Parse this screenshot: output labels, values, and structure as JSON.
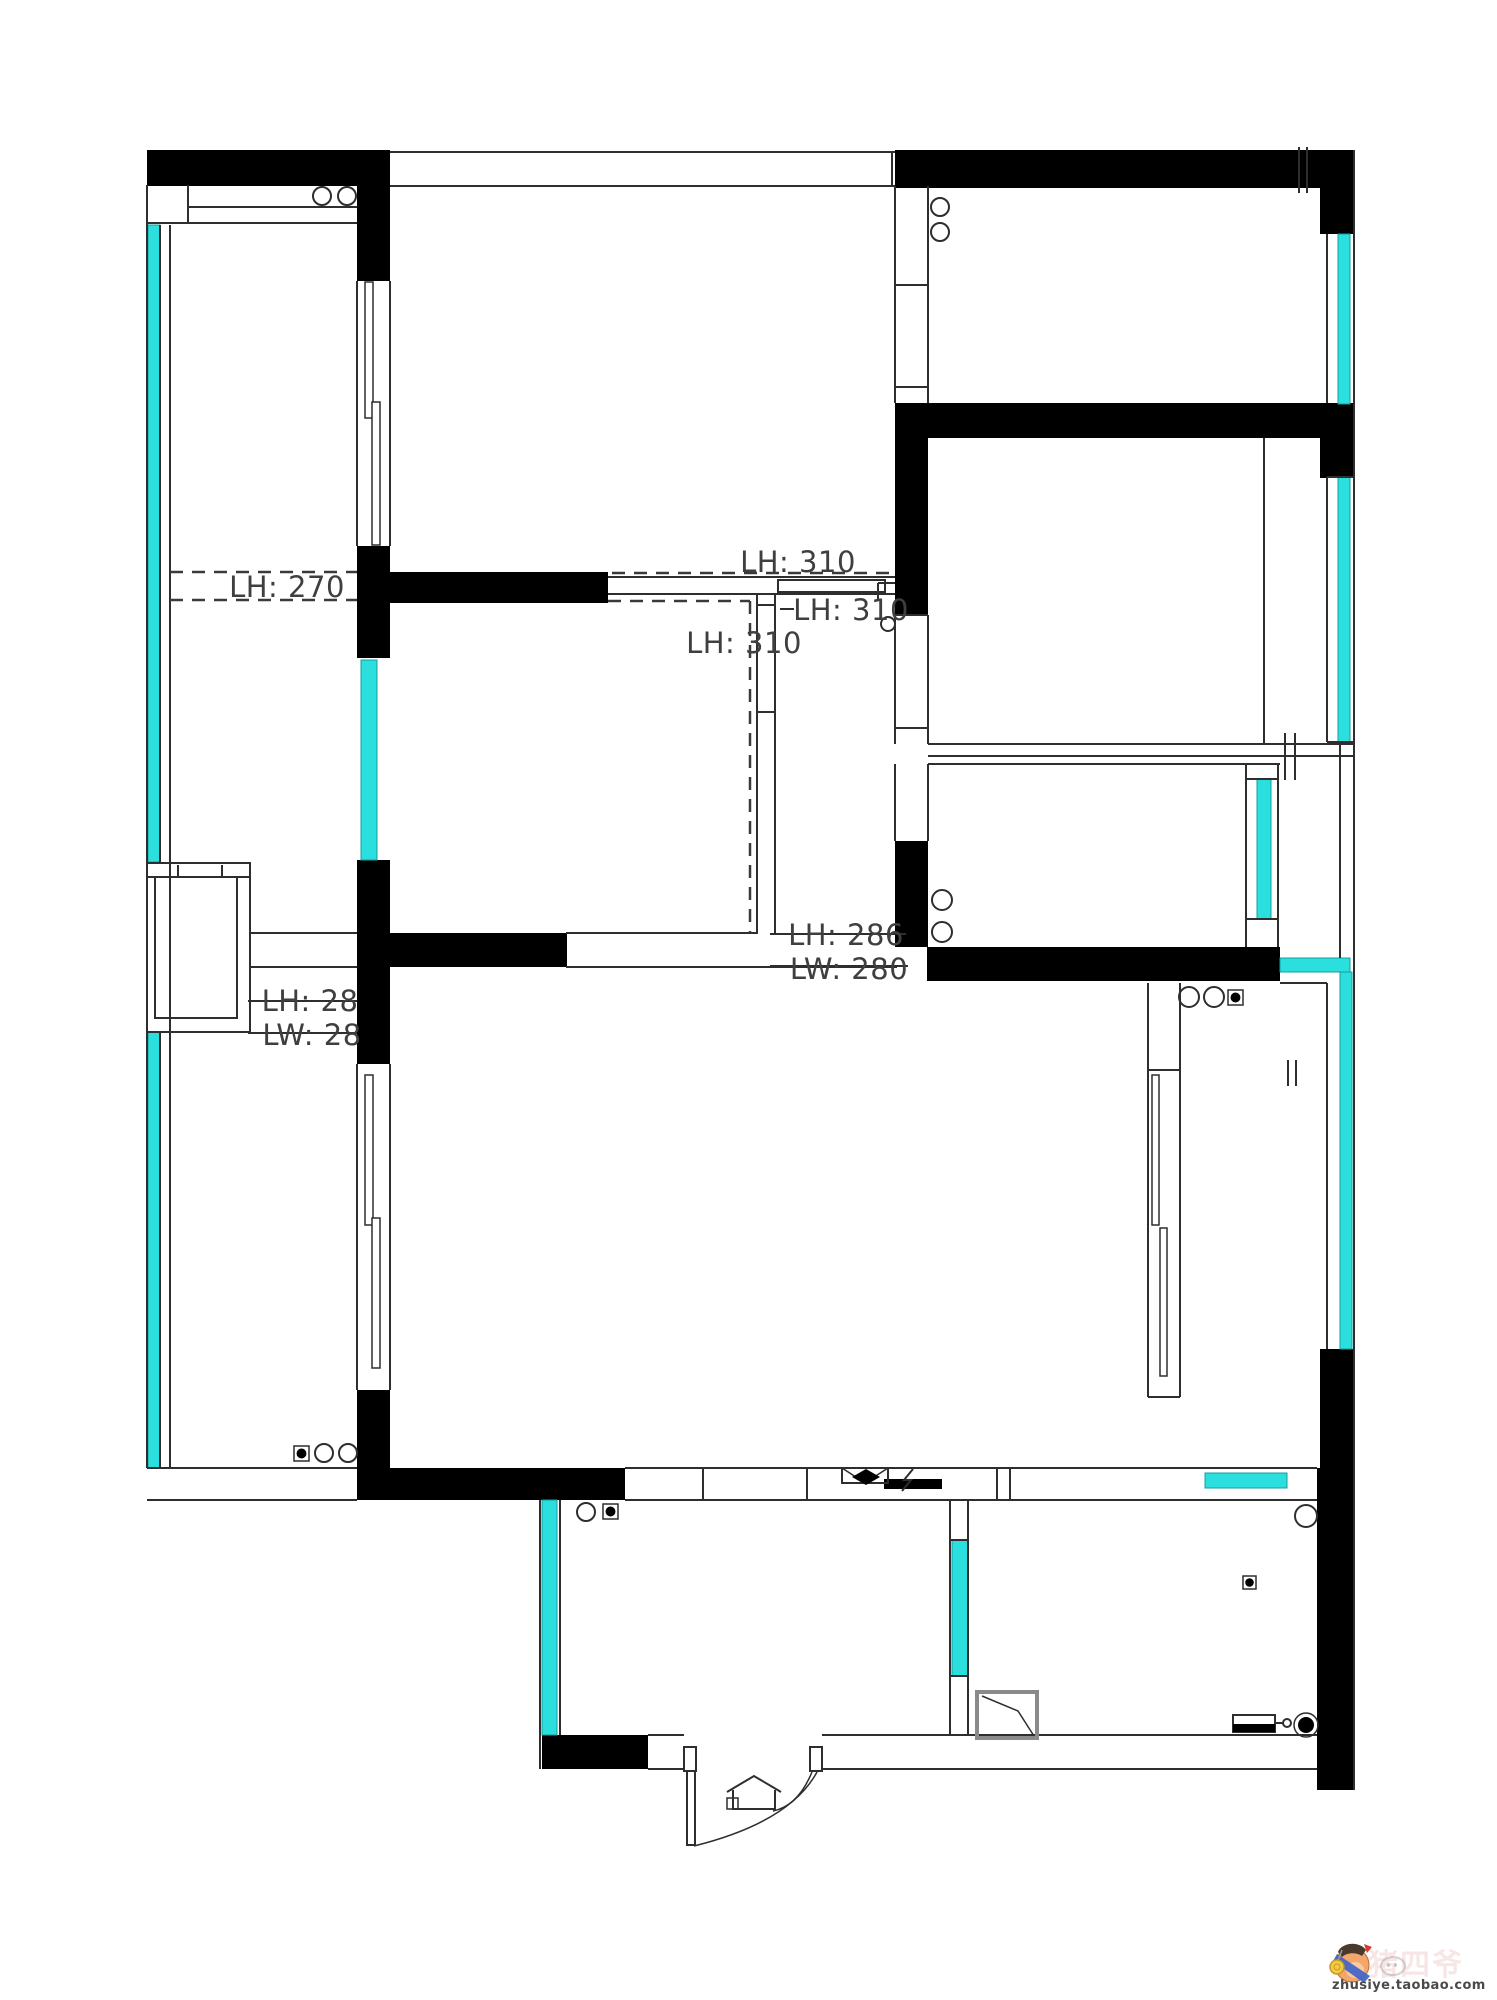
{
  "meta": {
    "width": 1497,
    "height": 2000,
    "bg": "#ffffff"
  },
  "colors": {
    "wall": "#000000",
    "window": "#2bdfdf",
    "window_edge": "#149c9c",
    "line": "#2e2e2e",
    "dash": "#3a3a3a",
    "label": "#3f3f3f",
    "shower_edge": "#8a8a8a"
  },
  "labels": [
    {
      "text": "LH: 270",
      "x": 287,
      "y": 597,
      "size": 29
    },
    {
      "text": "LH: 310",
      "x": 798,
      "y": 572,
      "size": 29
    },
    {
      "text": "LH: 310",
      "x": 851,
      "y": 620,
      "size": 29
    },
    {
      "text": "LH: 310",
      "x": 744,
      "y": 653,
      "size": 29
    },
    {
      "text": "LH: 286",
      "x": 846,
      "y": 945,
      "size": 29
    },
    {
      "text": "LW: 280",
      "x": 849,
      "y": 979,
      "size": 29
    },
    {
      "text": "LH: 28",
      "x": 310,
      "y": 1011,
      "size": 29
    },
    {
      "text": "LW: 28",
      "x": 312,
      "y": 1045,
      "size": 29
    }
  ],
  "walls": [
    [
      147,
      150,
      243,
      36
    ],
    [
      895,
      150,
      459,
      38
    ],
    [
      1320,
      150,
      34,
      84
    ],
    [
      357,
      185,
      33,
      96
    ],
    [
      357,
      546,
      33,
      112
    ],
    [
      390,
      572,
      218,
      31
    ],
    [
      895,
      403,
      33,
      212
    ],
    [
      895,
      403,
      459,
      35
    ],
    [
      1320,
      438,
      34,
      40
    ],
    [
      357,
      860,
      33,
      204
    ],
    [
      390,
      933,
      177,
      34
    ],
    [
      895,
      841,
      33,
      106
    ],
    [
      927,
      947,
      353,
      34
    ],
    [
      1320,
      1349,
      34,
      120
    ],
    [
      357,
      1390,
      33,
      110
    ],
    [
      390,
      1468,
      235,
      32
    ],
    [
      884,
      1479,
      58,
      10
    ],
    [
      1317,
      1468,
      37,
      322
    ],
    [
      542,
      1735,
      106,
      34
    ]
  ],
  "windows": [
    [
      148,
      225,
      12,
      637
    ],
    [
      148,
      1032,
      12,
      436
    ],
    [
      361,
      660,
      16,
      200
    ],
    [
      1338,
      234,
      12,
      170
    ],
    [
      1338,
      477,
      12,
      265
    ],
    [
      1257,
      779,
      14,
      140
    ],
    [
      1280,
      958,
      70,
      14
    ],
    [
      1340,
      972,
      12,
      377
    ],
    [
      542,
      1500,
      15,
      235
    ],
    [
      952,
      1540,
      16,
      136
    ],
    [
      1205,
      1473,
      82,
      15
    ]
  ],
  "lines": [
    [
      147,
      185,
      147,
      1468
    ],
    [
      160,
      225,
      160,
      862
    ],
    [
      160,
      1032,
      160,
      1468
    ],
    [
      170,
      225,
      170,
      1468
    ],
    [
      148,
      223,
      357,
      223
    ],
    [
      188,
      185,
      188,
      223
    ],
    [
      188,
      207,
      357,
      207
    ],
    [
      147,
      1468,
      357,
      1468
    ],
    [
      147,
      1500,
      357,
      1500
    ],
    [
      390,
      152,
      895,
      152
    ],
    [
      390,
      186,
      895,
      186
    ],
    [
      892,
      152,
      892,
      186
    ],
    [
      895,
      186,
      895,
      403
    ],
    [
      928,
      186,
      928,
      403
    ],
    [
      895,
      285,
      928,
      285
    ],
    [
      895,
      387,
      928,
      387
    ],
    [
      1354,
      150,
      1354,
      1790
    ],
    [
      1327,
      234,
      1327,
      403
    ],
    [
      1327,
      477,
      1327,
      742
    ],
    [
      1327,
      983,
      1327,
      1349
    ],
    [
      1327,
      477,
      1354,
      477
    ],
    [
      1327,
      742,
      1354,
      742
    ],
    [
      895,
      615,
      895,
      744
    ],
    [
      928,
      615,
      928,
      744
    ],
    [
      895,
      615,
      928,
      615
    ],
    [
      895,
      728,
      928,
      728
    ],
    [
      1264,
      438,
      1264,
      744
    ],
    [
      928,
      744,
      1354,
      744
    ],
    [
      928,
      756,
      1354,
      756
    ],
    [
      928,
      764,
      1280,
      764
    ],
    [
      878,
      583,
      895,
      583
    ],
    [
      878,
      583,
      878,
      600
    ],
    [
      895,
      764,
      895,
      841
    ],
    [
      928,
      764,
      928,
      841
    ],
    [
      1246,
      764,
      1246,
      947
    ],
    [
      1278,
      764,
      1278,
      947
    ],
    [
      1246,
      779,
      1278,
      779
    ],
    [
      1246,
      919,
      1278,
      919
    ],
    [
      1340,
      742,
      1340,
      958
    ],
    [
      1280,
      983,
      1327,
      983
    ],
    [
      608,
      577,
      895,
      577
    ],
    [
      608,
      594,
      895,
      594
    ],
    [
      757,
      594,
      757,
      933
    ],
    [
      775,
      594,
      775,
      933
    ],
    [
      757,
      605,
      775,
      605
    ],
    [
      757,
      712,
      775,
      712
    ],
    [
      250,
      933,
      357,
      933
    ],
    [
      566,
      933,
      758,
      933
    ],
    [
      250,
      967,
      357,
      967
    ],
    [
      566,
      967,
      897,
      967
    ],
    [
      147,
      877,
      250,
      877
    ],
    [
      178,
      865,
      178,
      877
    ],
    [
      222,
      865,
      222,
      877
    ],
    [
      625,
      1468,
      1317,
      1468
    ],
    [
      625,
      1500,
      1317,
      1500
    ],
    [
      703,
      1468,
      703,
      1500
    ],
    [
      807,
      1468,
      807,
      1500
    ],
    [
      997,
      1468,
      997,
      1500
    ],
    [
      1010,
      1468,
      1010,
      1500
    ],
    [
      1148,
      983,
      1148,
      1397
    ],
    [
      1180,
      983,
      1180,
      1397
    ],
    [
      1148,
      1070,
      1180,
      1070
    ],
    [
      1148,
      1397,
      1180,
      1397
    ],
    [
      357,
      281,
      357,
      546
    ],
    [
      390,
      281,
      390,
      546
    ],
    [
      357,
      1064,
      357,
      1390
    ],
    [
      390,
      1064,
      390,
      1390
    ],
    [
      540,
      1500,
      540,
      1769
    ],
    [
      560,
      1500,
      560,
      1735
    ],
    [
      950,
      1500,
      950,
      1735
    ],
    [
      968,
      1500,
      968,
      1735
    ],
    [
      950,
      1540,
      968,
      1540
    ],
    [
      950,
      1676,
      968,
      1676
    ],
    [
      648,
      1735,
      684,
      1735
    ],
    [
      822,
      1735,
      1317,
      1735
    ],
    [
      648,
      1769,
      684,
      1769
    ],
    [
      822,
      1769,
      1317,
      1769
    ],
    [
      1299,
      147,
      1299,
      193
    ],
    [
      1307,
      147,
      1307,
      193
    ],
    [
      1285,
      733,
      1285,
      780
    ],
    [
      1295,
      733,
      1295,
      780
    ],
    [
      1288,
      1060,
      1288,
      1086
    ],
    [
      1296,
      1060,
      1296,
      1086
    ],
    [
      770,
      934,
      906,
      934
    ],
    [
      770,
      966,
      908,
      966
    ],
    [
      248,
      1001,
      357,
      1001
    ],
    [
      248,
      1033,
      357,
      1033
    ],
    [
      780,
      609,
      794,
      609
    ]
  ],
  "dashes": [
    [
      170,
      572,
      357,
      572
    ],
    [
      170,
      600,
      357,
      600
    ],
    [
      612,
      573,
      893,
      573
    ],
    [
      608,
      601,
      750,
      601
    ],
    [
      750,
      601,
      750,
      933
    ]
  ],
  "track_rects": [
    [
      365,
      282,
      8,
      136
    ],
    [
      372,
      402,
      8,
      143
    ],
    [
      365,
      1075,
      8,
      150
    ],
    [
      372,
      1218,
      8,
      150
    ],
    [
      1152,
      1075,
      7,
      150
    ],
    [
      1160,
      1228,
      7,
      148
    ]
  ],
  "outline_rects": [
    {
      "r": [
        778,
        580,
        107,
        12
      ]
    },
    {
      "r": [
        147,
        863,
        103,
        169
      ]
    },
    {
      "r": [
        155,
        877,
        82,
        141
      ]
    },
    {
      "r": [
        684,
        1747,
        12,
        24
      ]
    },
    {
      "r": [
        810,
        1747,
        12,
        24
      ]
    },
    {
      "r": [
        687,
        1771,
        8,
        74
      ]
    },
    {
      "r": [
        1233,
        1715,
        42,
        17
      ]
    },
    {
      "r": [
        842,
        1468,
        46,
        15
      ]
    },
    {
      "r": [
        977,
        1692,
        60,
        46
      ],
      "stroke": "#8a8a8a",
      "sw": 4
    }
  ],
  "filled_rects": [
    [
      1233,
      1724,
      42,
      8
    ]
  ],
  "paths": [
    {
      "d": "M842,1468 L865,1483 L888,1468",
      "sw": 1.5
    },
    {
      "d": "M852,1477 L866,1469 L880,1477 L866,1485 Z",
      "fill": "#000000",
      "sw": 0
    },
    {
      "d": "M913,1469 L904,1480 L911,1480 L902,1491",
      "sw": 2
    },
    {
      "d": "M694,1846 Q790,1822 817,1772",
      "sw": 1.5
    },
    {
      "d": "M812,1772 Q798,1806 773,1811",
      "sw": 1.5
    },
    {
      "d": "M727,1792 L754,1776 L781,1792",
      "sw": 2
    },
    {
      "d": "M733,1790 L733,1809 L775,1809 L775,1790",
      "sw": 2
    },
    {
      "d": "M727,1798 L738,1798 L738,1809 L727,1809 Z",
      "sw": 1.5
    },
    {
      "d": "M982,1696 L1018,1711 L1034,1736",
      "sw": 1.5
    },
    {
      "d": "M1275,1723 L1283,1723",
      "sw": 2
    }
  ],
  "circles": [
    [
      322,
      196,
      9
    ],
    [
      347,
      196,
      9
    ],
    [
      940,
      207,
      9
    ],
    [
      940,
      232,
      9
    ],
    [
      942,
      900,
      10
    ],
    [
      942,
      932,
      10
    ],
    [
      1189,
      997,
      10
    ],
    [
      1214,
      997,
      10
    ],
    [
      324,
      1453,
      9
    ],
    [
      348,
      1453,
      9
    ],
    [
      586,
      1512,
      9
    ],
    [
      888,
      624,
      7
    ],
    [
      1287,
      1723,
      4
    ],
    [
      1306,
      1516,
      11
    ]
  ],
  "filled_circles": [
    [
      1306,
      1725,
      8
    ]
  ],
  "ring_circles": [
    [
      1306,
      1725,
      12
    ]
  ],
  "dot_squares": [
    [
      294,
      1446,
      15
    ],
    [
      603,
      1504,
      15
    ],
    [
      1228,
      990,
      15
    ],
    [
      1243,
      1576,
      13
    ]
  ],
  "watermark": {
    "text": "zhusiye.taobao.com",
    "faint": "猪四爷"
  }
}
